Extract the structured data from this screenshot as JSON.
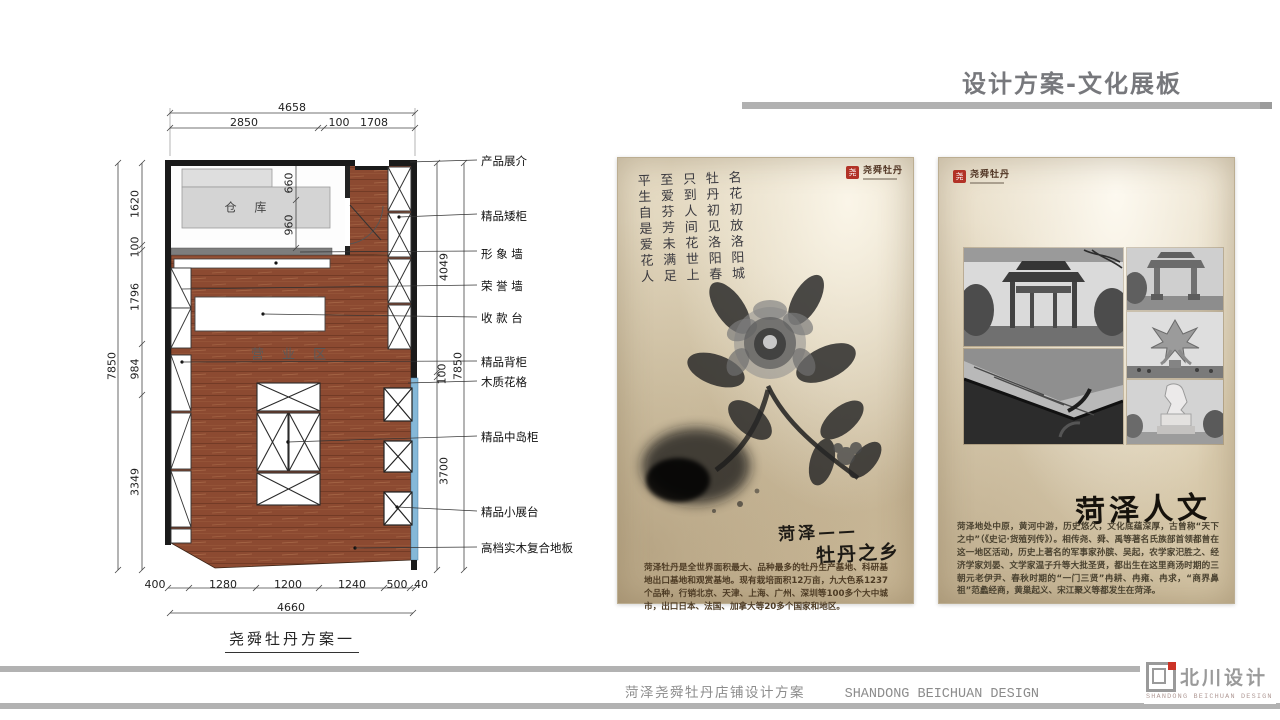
{
  "slide": {
    "title": "设计方案-文化展板",
    "footer": {
      "zh": "菏泽尧舜牡丹店铺设计方案",
      "en": "SHANDONG BEICHUAN DESIGN"
    },
    "corp_logo": {
      "name": "北川设计",
      "tagline": "SHANDONG BEICHUAN DESIGN"
    },
    "colors": {
      "accent_gray": "#b1b1b1",
      "title_gray": "#77787c",
      "logo_red": "#cb3327",
      "wood_floor": "#8c4a31",
      "glass_blue": "#85b8d8",
      "parchment": "#dacdb0"
    }
  },
  "floor_plan": {
    "caption": "尧舜牡丹方案一",
    "rooms": {
      "warehouse": "仓 库",
      "business_area": "营 业 区"
    },
    "dims": {
      "top_total": "4658",
      "top_segments": [
        "2850",
        "100",
        "1708"
      ],
      "left_total": "7850",
      "left_segments": [
        "1620",
        "100",
        "1796",
        "984",
        "3349"
      ],
      "right_total": "7850",
      "right_segments": [
        "4049",
        "100",
        "3700"
      ],
      "bottom_total": "4660",
      "bottom_segments": [
        "400",
        "1280",
        "1200",
        "1240",
        "500",
        "40"
      ],
      "door": [
        "660",
        "960"
      ]
    },
    "callouts": [
      "产品展介",
      "精品矮柜",
      "形 象 墙",
      "荣 誉 墙",
      "收 款 台",
      "精品背柜",
      "木质花格",
      "精品中岛柜",
      "精品小展台",
      "高档实木复合地板"
    ]
  },
  "poster_left": {
    "brand": "尧舜牡丹",
    "seal_glyph": "尧",
    "poem": "名花初放洛阳城\n牡丹初见洛阳春\n只到人间花世上\n至爱芬芳未满足\n平生自是爱花人",
    "title_line1": "菏泽——",
    "title_line2": "牡丹之乡",
    "body": "菏泽牡丹是全世界面积最大、品种最多的牡丹生产基地、科研基地出口基地和观赏基地。现有栽培面积12万亩，九大色系1237个品种，行销北京、天津、上海、广州、深圳等100多个大中城市，出口日本、法国、加拿大等20多个国家和地区。"
  },
  "poster_right": {
    "brand": "尧舜牡丹",
    "seal_glyph": "尧",
    "title": "菏泽人文",
    "body": "菏泽地处中原，黄河中游，历史悠久，文化底蕴深厚，古曾称“天下之中”（《史记·货殖列传》）。相传尧、舜、禹等著名氏族部首领都曾在这一地区活动，历史上著名的军事家孙膑、吴起，农学家汜胜之、经济学家刘晏、文学家温子升等大批圣贤，都出生在这里商汤时期的三朝元老伊尹、春秋时期的“一门三贤”冉耕、冉雍、冉求，“商界鼻祖”范蠡经商，黄巢起义、宋江聚义等都发生在菏泽。"
  }
}
